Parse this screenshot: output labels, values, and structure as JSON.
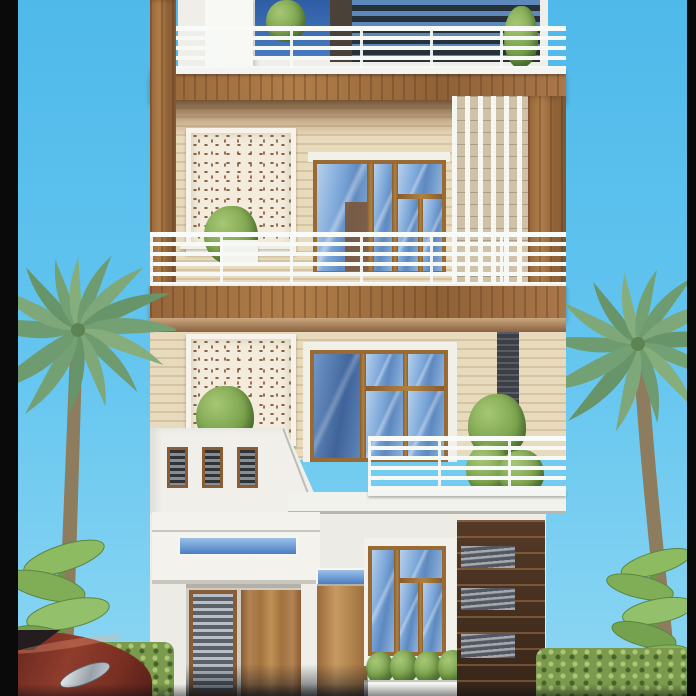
{
  "scene": {
    "type": "3d-architectural-render",
    "subject": "Front elevation of a modern three-storey residence with roof terrace, balconies, perforated jali panels, wood cladding, palm trees, hedges and a parked car",
    "visible_text": []
  },
  "palette": {
    "letterbox_bar": "#0a0a0a",
    "sky_top": "#4fb9ea",
    "sky_bottom": "#8ed7f3",
    "wood_cladding": "#a1713f",
    "wood_frame": "#9a6a35",
    "dark_feature_wood": "#4e3523",
    "stone_accent": "#7e848d",
    "stripe_wall_light": "#e8dabc",
    "stripe_wall_dark": "#d6c3a1",
    "jali_base": "#f3ecdd",
    "jali_motif": "#8a6244",
    "railing_white": "#f7f9f7",
    "white_wall": "#efeee8",
    "glass_blue": "#7ba6d8",
    "glass_deep": "#3f639a",
    "canopy_glass": "#4a7ec2",
    "shutter_gray": "#9aa0a8",
    "hedge_green": "#7c9a4d",
    "palm_green": "#74a174",
    "banana_green": "#7fae57",
    "car_red": "#7e3126"
  },
  "building": {
    "levels": [
      {
        "name": "roof-terrace",
        "features": [
          "white-railing",
          "glass-penthouse-louvers",
          "potted-plants"
        ]
      },
      {
        "name": "second-floor-balcony",
        "features": [
          "jali-panel",
          "blue-glass-windows",
          "vertical-slat-screen",
          "white-railing",
          "balcony-plant"
        ]
      },
      {
        "name": "first-floor-balcony",
        "features": [
          "jali-panel",
          "blue-glass-window",
          "stone-accent-strip",
          "white-parapet-with-vents",
          "white-railing",
          "plants"
        ]
      },
      {
        "name": "ground-floor",
        "features": [
          "canopy-with-blue-transom",
          "rolling-shutter",
          "wood-doors",
          "blue-glass-window",
          "planter-box",
          "dark-wood-feature-wall"
        ]
      }
    ]
  },
  "surroundings": [
    "left-palm-tree",
    "right-palm-tree",
    "banana-plants",
    "green-hedges",
    "parked-red-car"
  ]
}
